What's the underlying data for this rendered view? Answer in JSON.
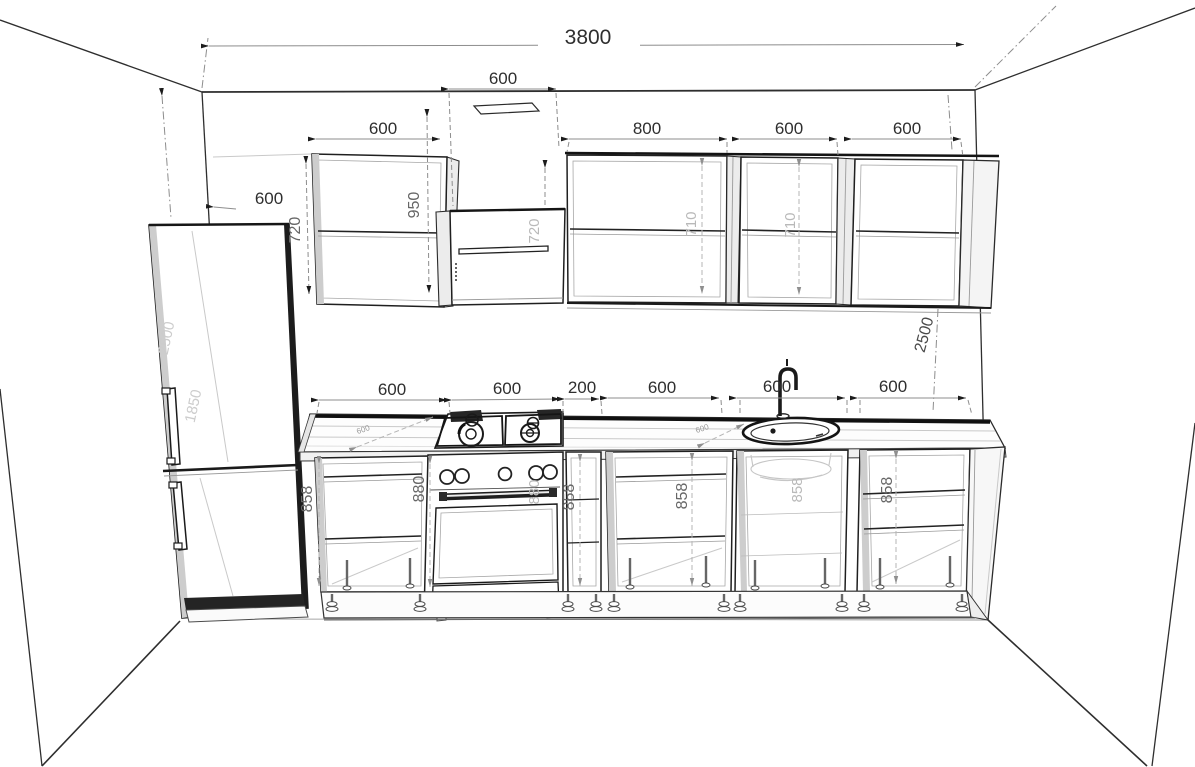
{
  "drawing": {
    "type": "kitchen-elevation-cad-drawing",
    "units": "mm"
  },
  "dims": {
    "total_width": "3800",
    "hood_width": "600",
    "wall_to_cabinet": "600",
    "upper_cab1_width": "600",
    "upper_cab2_width": "800",
    "upper_cab3_width": "600",
    "upper_cab4_width": "600",
    "upper_cab1_height": "950",
    "upper_cab1_side_height": "720",
    "hood_cab_height": "720",
    "upper_cab2_inner_height": "710",
    "upper_cab3_inner_height": "710",
    "room_height": "2500",
    "fridge_height": "2500",
    "fridge_upper_section": "1850",
    "base_cab1_width": "600",
    "stove_width": "600",
    "filler_width": "200",
    "base_cab2_width": "600",
    "sink_cab_width": "600",
    "base_cab3_width": "600",
    "base_cab1_height": "858",
    "stove_height": "880",
    "stove_height_right": "880",
    "filler_height": "858",
    "base_cab2_height": "858",
    "sink_cab_height": "858",
    "base_cab3_height": "858",
    "counter_depth_a": "600",
    "counter_depth_b": "600"
  }
}
